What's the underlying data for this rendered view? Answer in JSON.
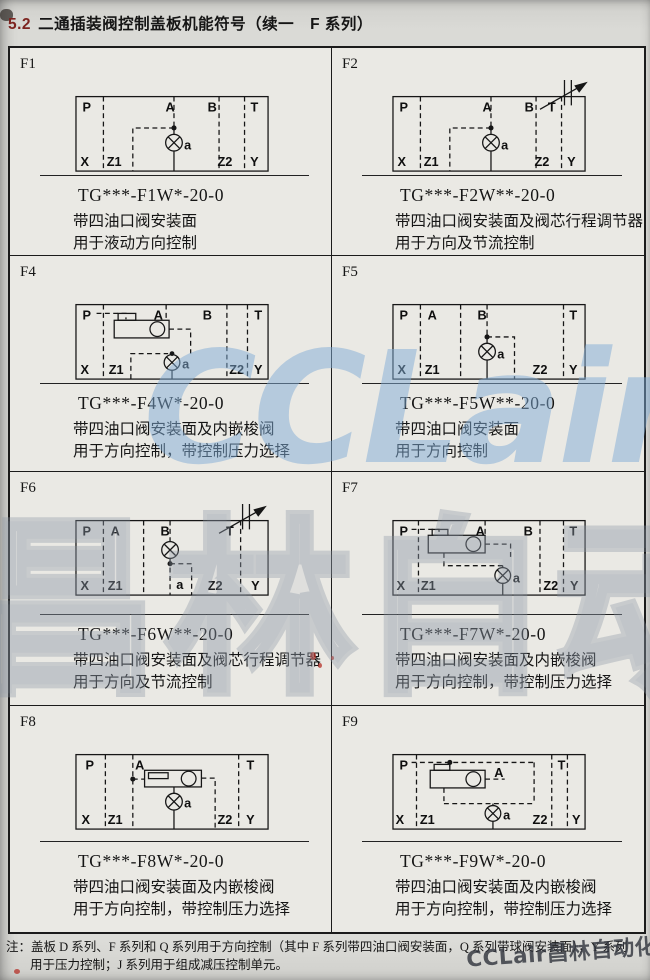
{
  "header": {
    "section": "5.2",
    "title": "二通插装阀控制盖板机能符号（续一　F 系列）"
  },
  "watermarks": {
    "big": "CCLair",
    "outline": "昌林自动化",
    "corner": "CCLair昌林自动化"
  },
  "note": {
    "label": "注：",
    "line1": "盖板 D 系列、F 系列和 Q 系列用于方向控制（其中 F 系列带四油口阀安装面，Q 系列带球阀安装面），Y 系列",
    "line2": "用于压力控制；J 系列用于组成减压控制单元。"
  },
  "cells": [
    {
      "id": "F1",
      "model": "TG***-F1W*-20-0",
      "desc1": "带四油口阀安装面",
      "desc2": "用于液动方向控制",
      "ports": {
        "P": "P",
        "A": "A",
        "B": "B",
        "T": "T",
        "X": "X",
        "Z1": "Z1",
        "a": "a",
        "Z2": "Z2",
        "Y": "Y"
      }
    },
    {
      "id": "F2",
      "model": "TG***-F2W**-20-0",
      "desc1": "带四油口阀安装面及阀芯行程调节器",
      "desc2": "用于方向及节流控制",
      "ports": {
        "P": "P",
        "A": "A",
        "B": "B",
        "T": "T",
        "X": "X",
        "Z1": "Z1",
        "a": "a",
        "Z2": "Z2",
        "Y": "Y"
      }
    },
    {
      "id": "F4",
      "model": "TG***-F4W*-20-0",
      "desc1": "带四油口阀安装面及内嵌梭阀",
      "desc2": "用于方向控制，带控制压力选择",
      "ports": {
        "P": "P",
        "A": "A",
        "B": "B",
        "T": "T",
        "X": "X",
        "Z1": "Z1",
        "a": "a",
        "Z2": "Z2",
        "Y": "Y"
      }
    },
    {
      "id": "F5",
      "model": "TG***-F5W**-20-0",
      "desc1": "带四油口阀安装面",
      "desc2": "用于方向控制",
      "ports": {
        "P": "P",
        "A": "A",
        "B": "B",
        "T": "T",
        "X": "X",
        "Z1": "Z1",
        "a": "a",
        "Z2": "Z2",
        "Y": "Y"
      }
    },
    {
      "id": "F6",
      "model": "TG***-F6W**-20-0",
      "desc1": "带四油口阀安装面及阀芯行程调节器",
      "desc2": "用于方向及节流控制",
      "ports": {
        "P": "P",
        "A": "A",
        "B": "B",
        "T": "T",
        "X": "X",
        "Z1": "Z1",
        "a": "a",
        "Z2": "Z2",
        "Y": "Y"
      }
    },
    {
      "id": "F7",
      "model": "TG***-F7W*-20-0",
      "desc1": "带四油口阀安装面及内嵌梭阀",
      "desc2": "用于方向控制，带控制压力选择",
      "ports": {
        "P": "P",
        "A": "A",
        "B": "B",
        "T": "T",
        "X": "X",
        "Z1": "Z1",
        "a": "a",
        "Z2": "Z2",
        "Y": "Y"
      }
    },
    {
      "id": "F8",
      "model": "TG***-F8W*-20-0",
      "desc1": "带四油口阀安装面及内嵌梭阀",
      "desc2": "用于方向控制，带控制压力选择",
      "ports": {
        "P": "P",
        "A": "A",
        "T": "T",
        "X": "X",
        "Z1": "Z1",
        "a": "a",
        "Z2": "Z2",
        "Y": "Y"
      }
    },
    {
      "id": "F9",
      "model": "TG***-F9W*-20-0",
      "desc1": "带四油口阀安装面及内嵌梭阀",
      "desc2": "用于方向控制，带控制压力选择",
      "ports": {
        "P": "P",
        "A": "A",
        "T": "T",
        "X": "X",
        "Z1": "Z1",
        "a": "a",
        "Z2": "Z2",
        "Y": "Y"
      }
    }
  ]
}
